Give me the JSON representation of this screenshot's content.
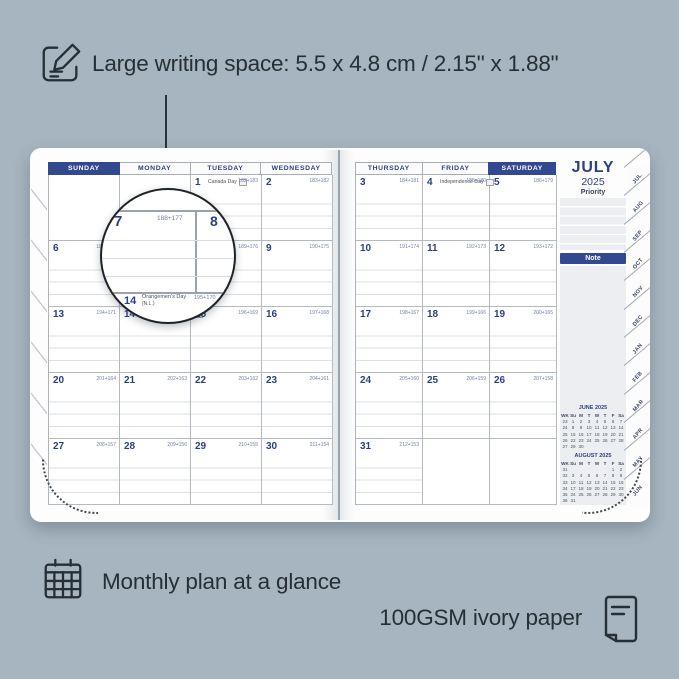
{
  "colors": {
    "background": "#a6b5bf",
    "navy_accent": "#32488f",
    "ink": "#272f36",
    "page": "#fdfdfe",
    "grid_line": "#b4bac2",
    "rule_line": "#dcdfe4",
    "panel_gray": "#edeef1"
  },
  "icons": {
    "top": "pencil-note",
    "bottom_left": "calendar-grid",
    "bottom_right": "paper-sheet"
  },
  "top_annotation": {
    "text": "Large writing space: 5.5 x 4.8 cm / 2.15\" x 1.88\""
  },
  "bottom_annotations": {
    "monthly": "Monthly plan at a glance",
    "paper": "100GSM ivory paper"
  },
  "planner": {
    "left_headers": [
      {
        "label": "SUNDAY",
        "cls": "dayhead hl"
      },
      {
        "label": "MONDAY",
        "cls": "dayhead"
      },
      {
        "label": "TUESDAY",
        "cls": "dayhead"
      },
      {
        "label": "WEDNESDAY",
        "cls": "dayhead"
      }
    ],
    "right_headers": [
      {
        "label": "THURSDAY",
        "cls": "dayhead"
      },
      {
        "label": "FRIDAY",
        "cls": "dayhead"
      },
      {
        "label": "SATURDAY",
        "cls": "dayhead hl"
      }
    ],
    "left_cells": [
      {
        "cls": "cell blank"
      },
      {
        "cls": "cell blank"
      },
      {
        "cls": "cell",
        "day": "1",
        "holiday": "Canada Day",
        "counts": "182+183"
      },
      {
        "cls": "cell",
        "day": "2",
        "counts": "183+182"
      },
      {
        "cls": "cell",
        "day": "6",
        "counts": "187+178"
      },
      {
        "cls": "cell",
        "day": "7",
        "counts": "188+177"
      },
      {
        "cls": "cell",
        "day": "8",
        "counts": "189+176"
      },
      {
        "cls": "cell",
        "day": "9",
        "counts": "190+175"
      },
      {
        "cls": "cell",
        "day": "13",
        "counts": "194+171"
      },
      {
        "cls": "cell",
        "day": "14",
        "holiday": "Orangemen's Day (N.L.)",
        "counts": "195+170"
      },
      {
        "cls": "cell",
        "day": "15",
        "counts": "196+169"
      },
      {
        "cls": "cell",
        "day": "16",
        "counts": "197+168"
      },
      {
        "cls": "cell",
        "day": "20",
        "counts": "201+164"
      },
      {
        "cls": "cell",
        "day": "21",
        "counts": "202+163"
      },
      {
        "cls": "cell",
        "day": "22",
        "counts": "203+162"
      },
      {
        "cls": "cell",
        "day": "23",
        "counts": "204+161"
      },
      {
        "cls": "cell",
        "day": "27",
        "counts": "208+157"
      },
      {
        "cls": "cell",
        "day": "28",
        "counts": "209+156"
      },
      {
        "cls": "cell",
        "day": "29",
        "counts": "210+155"
      },
      {
        "cls": "cell",
        "day": "30",
        "counts": "211+154"
      }
    ],
    "right_cells": [
      {
        "cls": "cell",
        "day": "3",
        "counts": "184+181"
      },
      {
        "cls": "cell",
        "day": "4",
        "holiday": "Independence Day",
        "counts": "185+180"
      },
      {
        "cls": "cell",
        "day": "5",
        "counts": "186+179"
      },
      {
        "cls": "cell",
        "day": "10",
        "counts": "191+174"
      },
      {
        "cls": "cell",
        "day": "11",
        "counts": "192+173"
      },
      {
        "cls": "cell",
        "day": "12",
        "counts": "193+172"
      },
      {
        "cls": "cell",
        "day": "17",
        "counts": "198+167"
      },
      {
        "cls": "cell",
        "day": "18",
        "counts": "199+166"
      },
      {
        "cls": "cell",
        "day": "19",
        "counts": "200+165"
      },
      {
        "cls": "cell",
        "day": "24",
        "counts": "205+160"
      },
      {
        "cls": "cell",
        "day": "25",
        "counts": "206+159"
      },
      {
        "cls": "cell",
        "day": "26",
        "counts": "207+158"
      },
      {
        "cls": "cell",
        "day": "31",
        "counts": "212+153"
      },
      {
        "cls": "cell blank"
      },
      {
        "cls": "cell blank"
      }
    ],
    "sidebar": {
      "month": "JULY",
      "year": "2025",
      "priority_label": "Priority",
      "note_label": "Note",
      "tabs": [
        "JUL",
        "AUG",
        "SEP",
        "OCT",
        "NOV",
        "DEC",
        "JAN",
        "FEB",
        "MAR",
        "APR",
        "MAY",
        "JUN"
      ],
      "minical_headers": [
        "WK",
        "Su",
        "M",
        "T",
        "W",
        "T",
        "F",
        "Sa"
      ],
      "june": {
        "title": "JUNE 2025",
        "rows": [
          [
            "23",
            "1",
            "2",
            "3",
            "4",
            "5",
            "6",
            "7"
          ],
          [
            "24",
            "8",
            "9",
            "10",
            "11",
            "12",
            "13",
            "14"
          ],
          [
            "25",
            "15",
            "16",
            "17",
            "18",
            "19",
            "20",
            "21"
          ],
          [
            "26",
            "22",
            "23",
            "24",
            "25",
            "26",
            "27",
            "28"
          ],
          [
            "27",
            "29",
            "30",
            "",
            "",
            "",
            "",
            ""
          ]
        ]
      },
      "august": {
        "title": "AUGUST 2025",
        "rows": [
          [
            "31",
            "",
            "",
            "",
            "",
            "",
            "1",
            "2"
          ],
          [
            "32",
            "3",
            "4",
            "5",
            "6",
            "7",
            "8",
            "9"
          ],
          [
            "33",
            "10",
            "11",
            "12",
            "13",
            "14",
            "15",
            "16"
          ],
          [
            "34",
            "17",
            "18",
            "19",
            "20",
            "21",
            "22",
            "23"
          ],
          [
            "35",
            "24",
            "25",
            "26",
            "27",
            "28",
            "29",
            "30"
          ],
          [
            "36",
            "31",
            "",
            "",
            "",
            "",
            "",
            ""
          ]
        ]
      }
    },
    "magnifier": {
      "day": "7",
      "counts": "188+177",
      "neighbor_day": "8",
      "sub_day": "14",
      "sub_holiday_line1": "Orangemen's Day",
      "sub_holiday_line2": "(N.L.)",
      "sub_counts": "195+170"
    }
  }
}
